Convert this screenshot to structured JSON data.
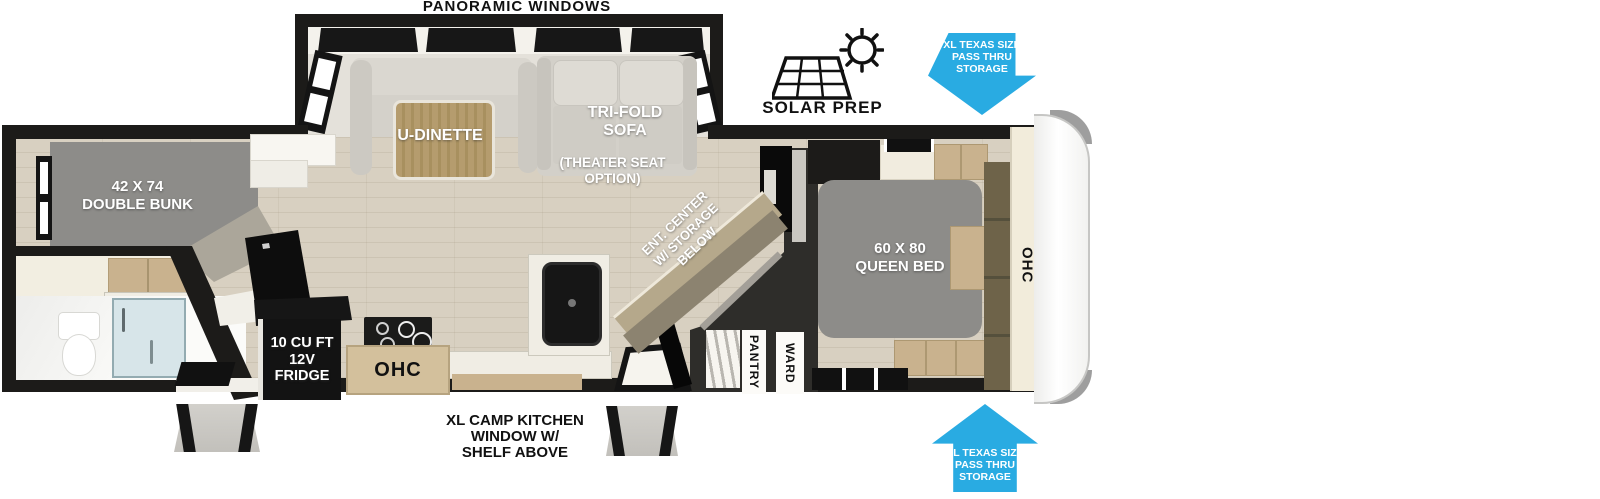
{
  "colors": {
    "wall": "#1C1B19",
    "floor": "#D8D0C1",
    "arrow-blue": "#29ABE2",
    "bed-gray": "#8D8C89",
    "cabinet-tan": "#C9B28E",
    "cabinet-tan-dark": "#AD9872",
    "ent-top": "#B5A88B",
    "ent-front": "#8C8370",
    "dark-wall": "#2E2D2A",
    "glass-blue": "#D7E5E9",
    "cream": "#F2ECDB",
    "counter": "#F0EDE4",
    "sofa-gray": "#D3D0C9",
    "table-wood": "#B59C6E",
    "slide-bg": "#E4E1DA"
  },
  "labels": {
    "panoramic_windows": "PANORAMIC WINDOWS",
    "u_dinette": "U-DINETTE",
    "tri_fold_sofa": "TRI-FOLD\nSOFA",
    "theater_seat_option": "(THEATER SEAT\nOPTION)",
    "solar_prep": "SOLAR PREP",
    "pass_thru_top": "XL TEXAS SIZE\nPASS THRU\nSTORAGE",
    "pass_thru_bottom": "XL TEXAS SIZE\nPASS THRU\nSTORAGE",
    "double_bunk": "42 X 74\nDOUBLE BUNK",
    "queen_bed": "60 X 80\nQUEEN BED",
    "ohc_kitchen": "OHC",
    "ohc_bedroom": "OHC",
    "ent_center": "ENT. CENTER\nW/ STORAGE\nBELOW",
    "pantry": "PANTRY",
    "ward": "WARD",
    "fridge": "10 CU FT\n12V\nFRIDGE",
    "camp_kitchen_window": "XL CAMP KITCHEN\nWINDOW W/\nSHELF ABOVE"
  }
}
